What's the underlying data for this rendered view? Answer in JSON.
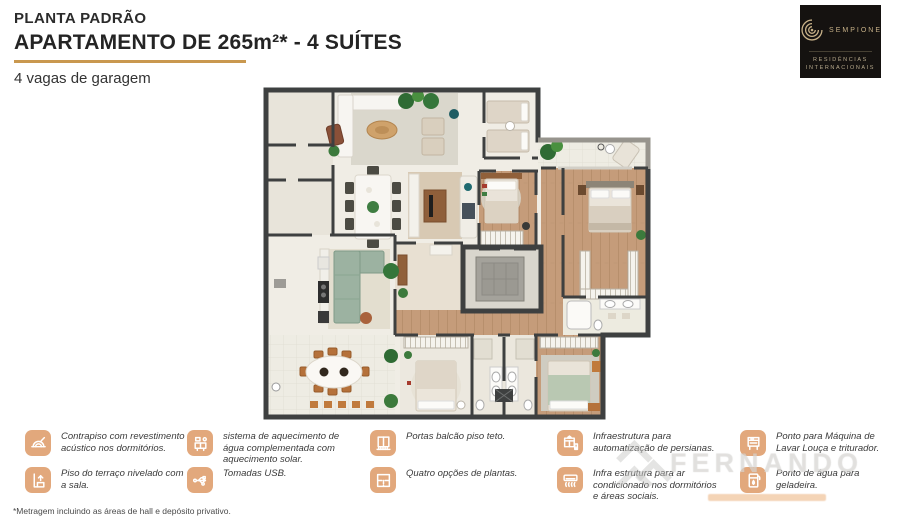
{
  "header": {
    "eyebrow": "PLANTA PADRÃO",
    "title": "APARTAMENTO DE 265m²* - 4 SUÍTES",
    "subtitle": "4 vagas de garagem"
  },
  "logo": {
    "brand": "SEMPIONE",
    "tagline_line1": "RESIDÊNCIAS",
    "tagline_line2": "INTERNACIONAIS"
  },
  "legend": {
    "items": [
      {
        "icon": "acoustic-floor-icon",
        "text": "Contrapiso com revestimento acústico nos dormitórios."
      },
      {
        "icon": "terrace-level-icon",
        "text": "Piso do terraço nivelado com a sala."
      },
      {
        "icon": "solar-water-heating-icon",
        "text": "sistema de aquecimento de água complementada com aquecimento solar."
      },
      {
        "icon": "usb-outlet-icon",
        "text": "Tomadas USB."
      },
      {
        "icon": "balcony-doors-icon",
        "text": "Portas balcão piso teto."
      },
      {
        "icon": "floor-plan-options-icon",
        "text": "Quatro opções de plantas."
      },
      {
        "icon": "blinds-automation-icon",
        "text": "Infraestrutura para automatização de persianas."
      },
      {
        "icon": "air-conditioning-icon",
        "text": "Infra estrutura para ar condicionado nos dormitórios e áreas sociais."
      },
      {
        "icon": "dishwasher-icon",
        "text": "Ponto para Máquina de Lavar Louça e triturador."
      },
      {
        "icon": "fridge-water-icon",
        "text": "Ponto de água para geladeira."
      }
    ]
  },
  "footnote": "*Metragem incluindo as áreas de hall e depósito privativo.",
  "watermark": {
    "text": "FERNANDO"
  },
  "palette": {
    "accent_gold": "#c9984f",
    "icon_bg": "#e2a87c",
    "logo_bg": "#151210",
    "logo_gold": "#c6b087",
    "wall_dark": "#3e4040",
    "wood_floor": "#c59c7a",
    "light_floor": "#f0ede5",
    "rug_gray": "#dad7cc",
    "sofa_green": "#9cb2a1",
    "plant_green": "#3c7a3c"
  }
}
